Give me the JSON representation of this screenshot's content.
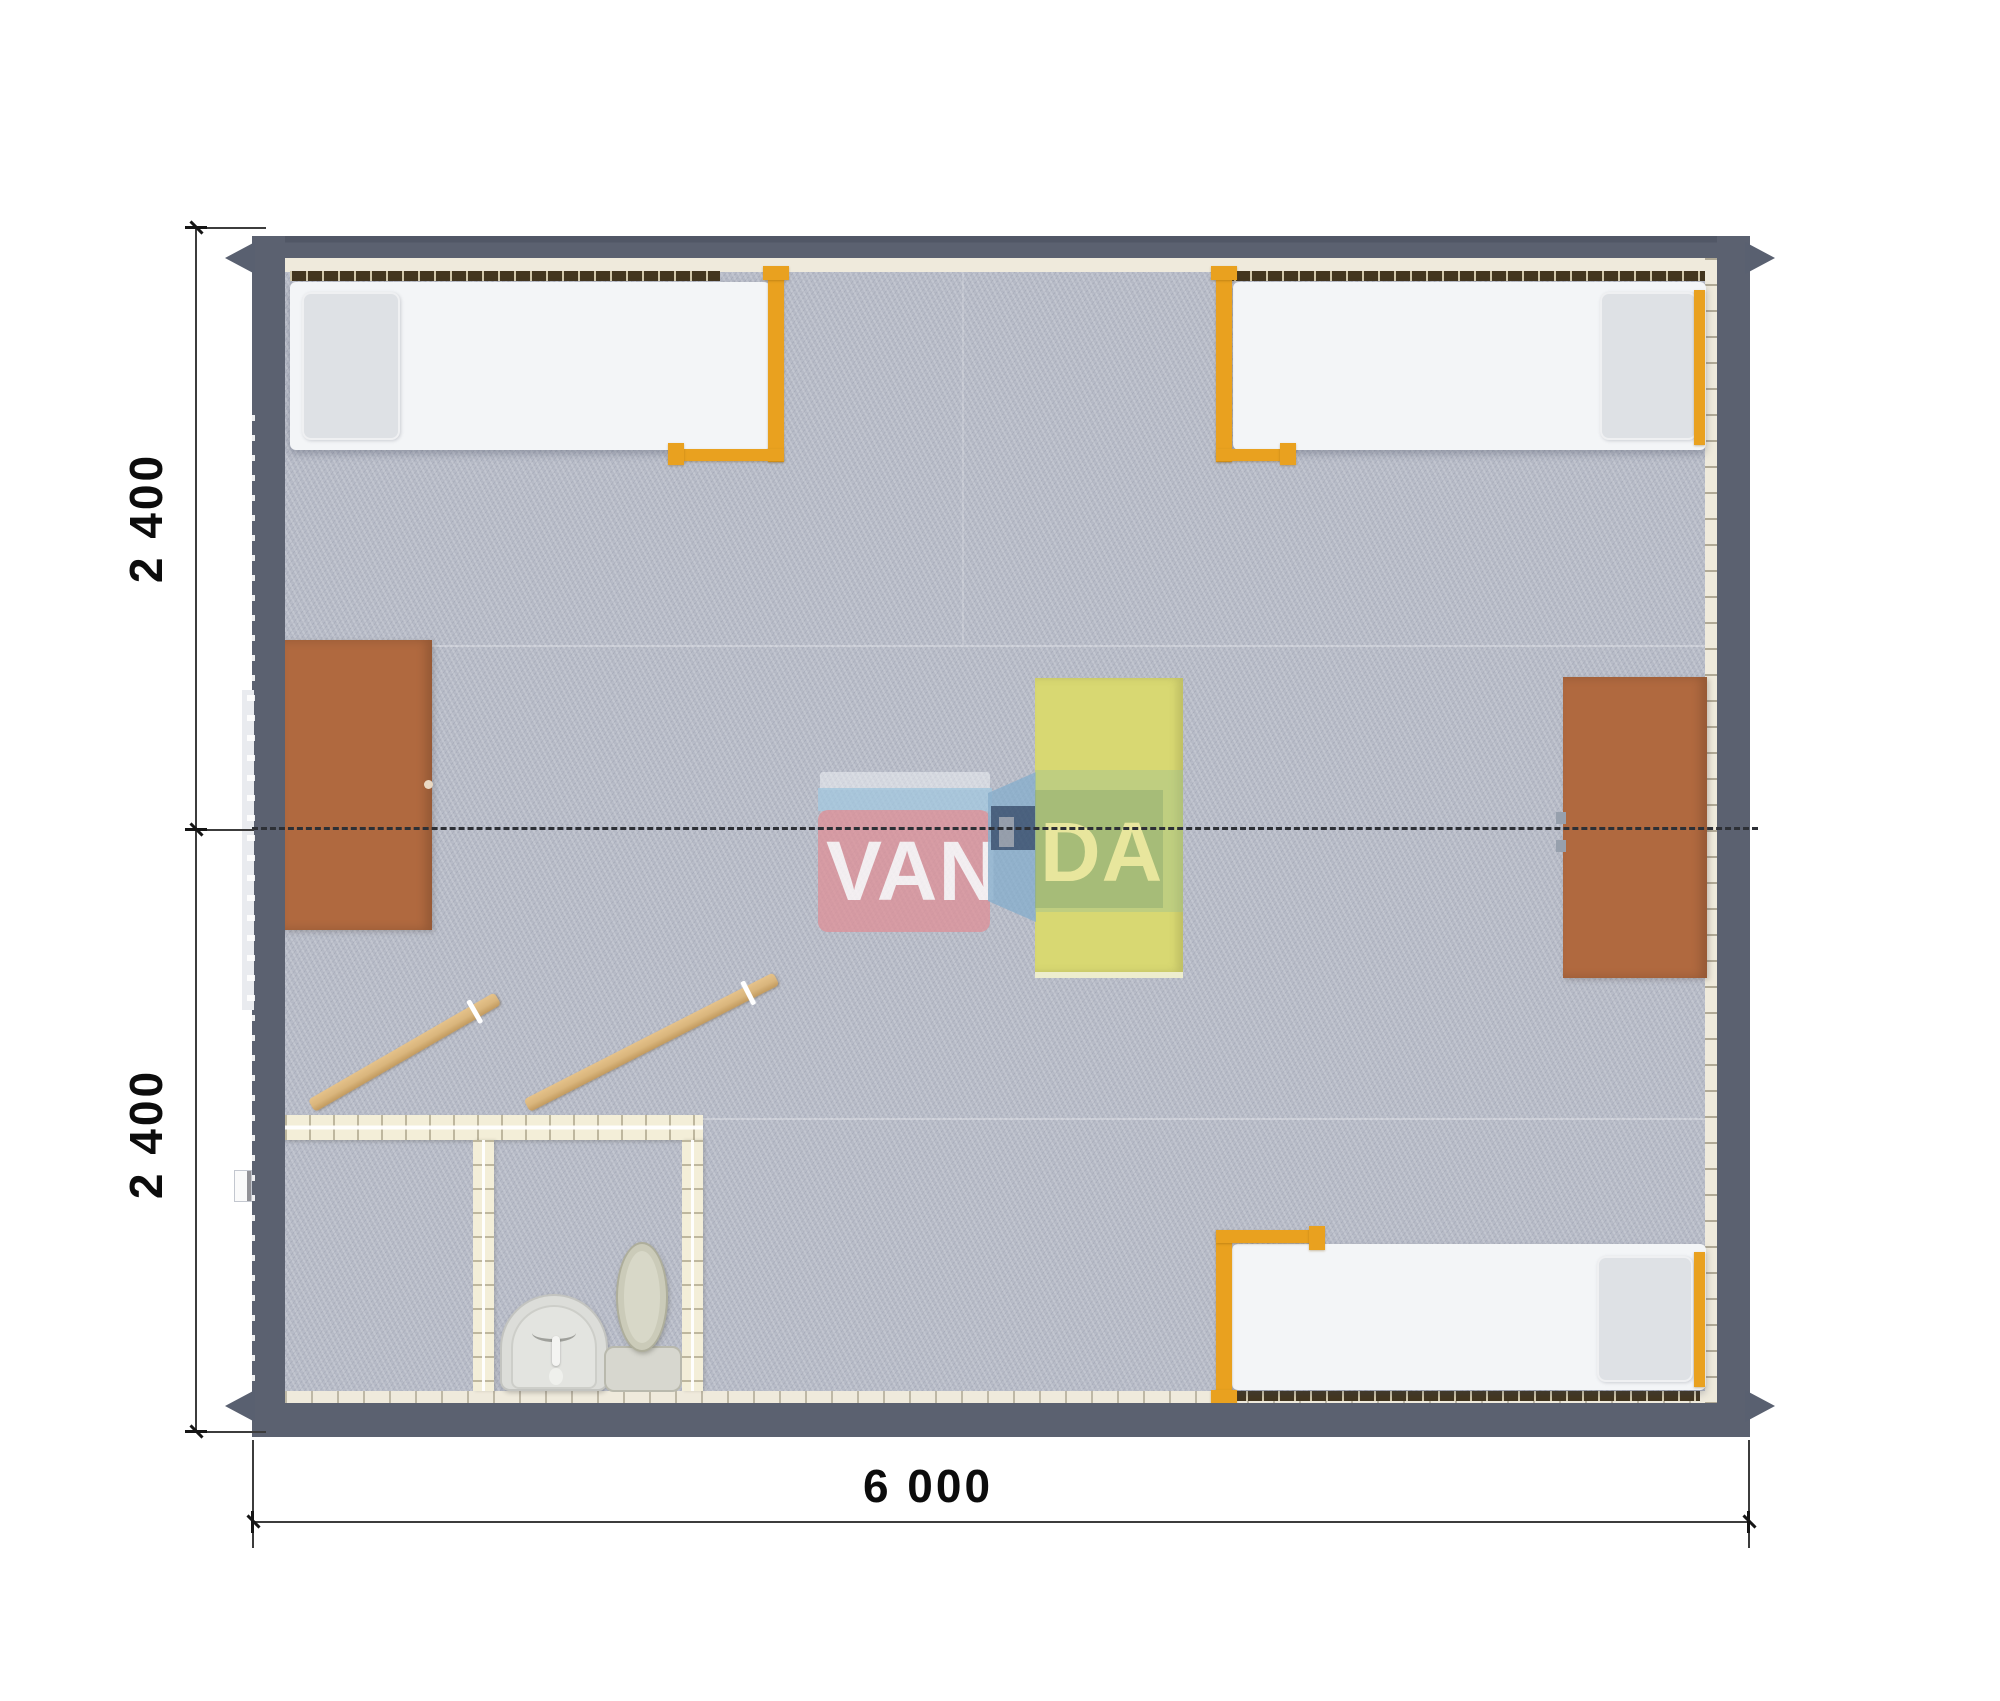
{
  "scene": {
    "kind": "modular cabin floor plan, rendered top view",
    "brand": "VANDA"
  },
  "dimension_labels": {
    "left_top": "2 400",
    "left_bottom": "2 400",
    "bottom": "6 000"
  },
  "watermark": {
    "left_text": "VAN",
    "right_text": "DA"
  },
  "palette": {
    "wall": "#5b6170",
    "wall_liner": "#efeadc",
    "carpet": "#b8bcc8",
    "bed": "#f3f5f7",
    "pillow": "#dee1e5",
    "bed_frame": "#e9a11f",
    "desk": "#b0693f",
    "table": "#d8d872",
    "bathroom_wall": "#f3eed8",
    "door": "#d9b57c",
    "fixture": "#dcddd9",
    "toilet": "#cbcbb9",
    "dash_line": "#2d3036",
    "dimension": "#3c3c3c",
    "logo_red": "#de9099",
    "logo_blue": "#a2c9e0",
    "logo_navy": "#365070",
    "logo_green": "#9ec294",
    "logo_letters": "#eeeba8"
  }
}
